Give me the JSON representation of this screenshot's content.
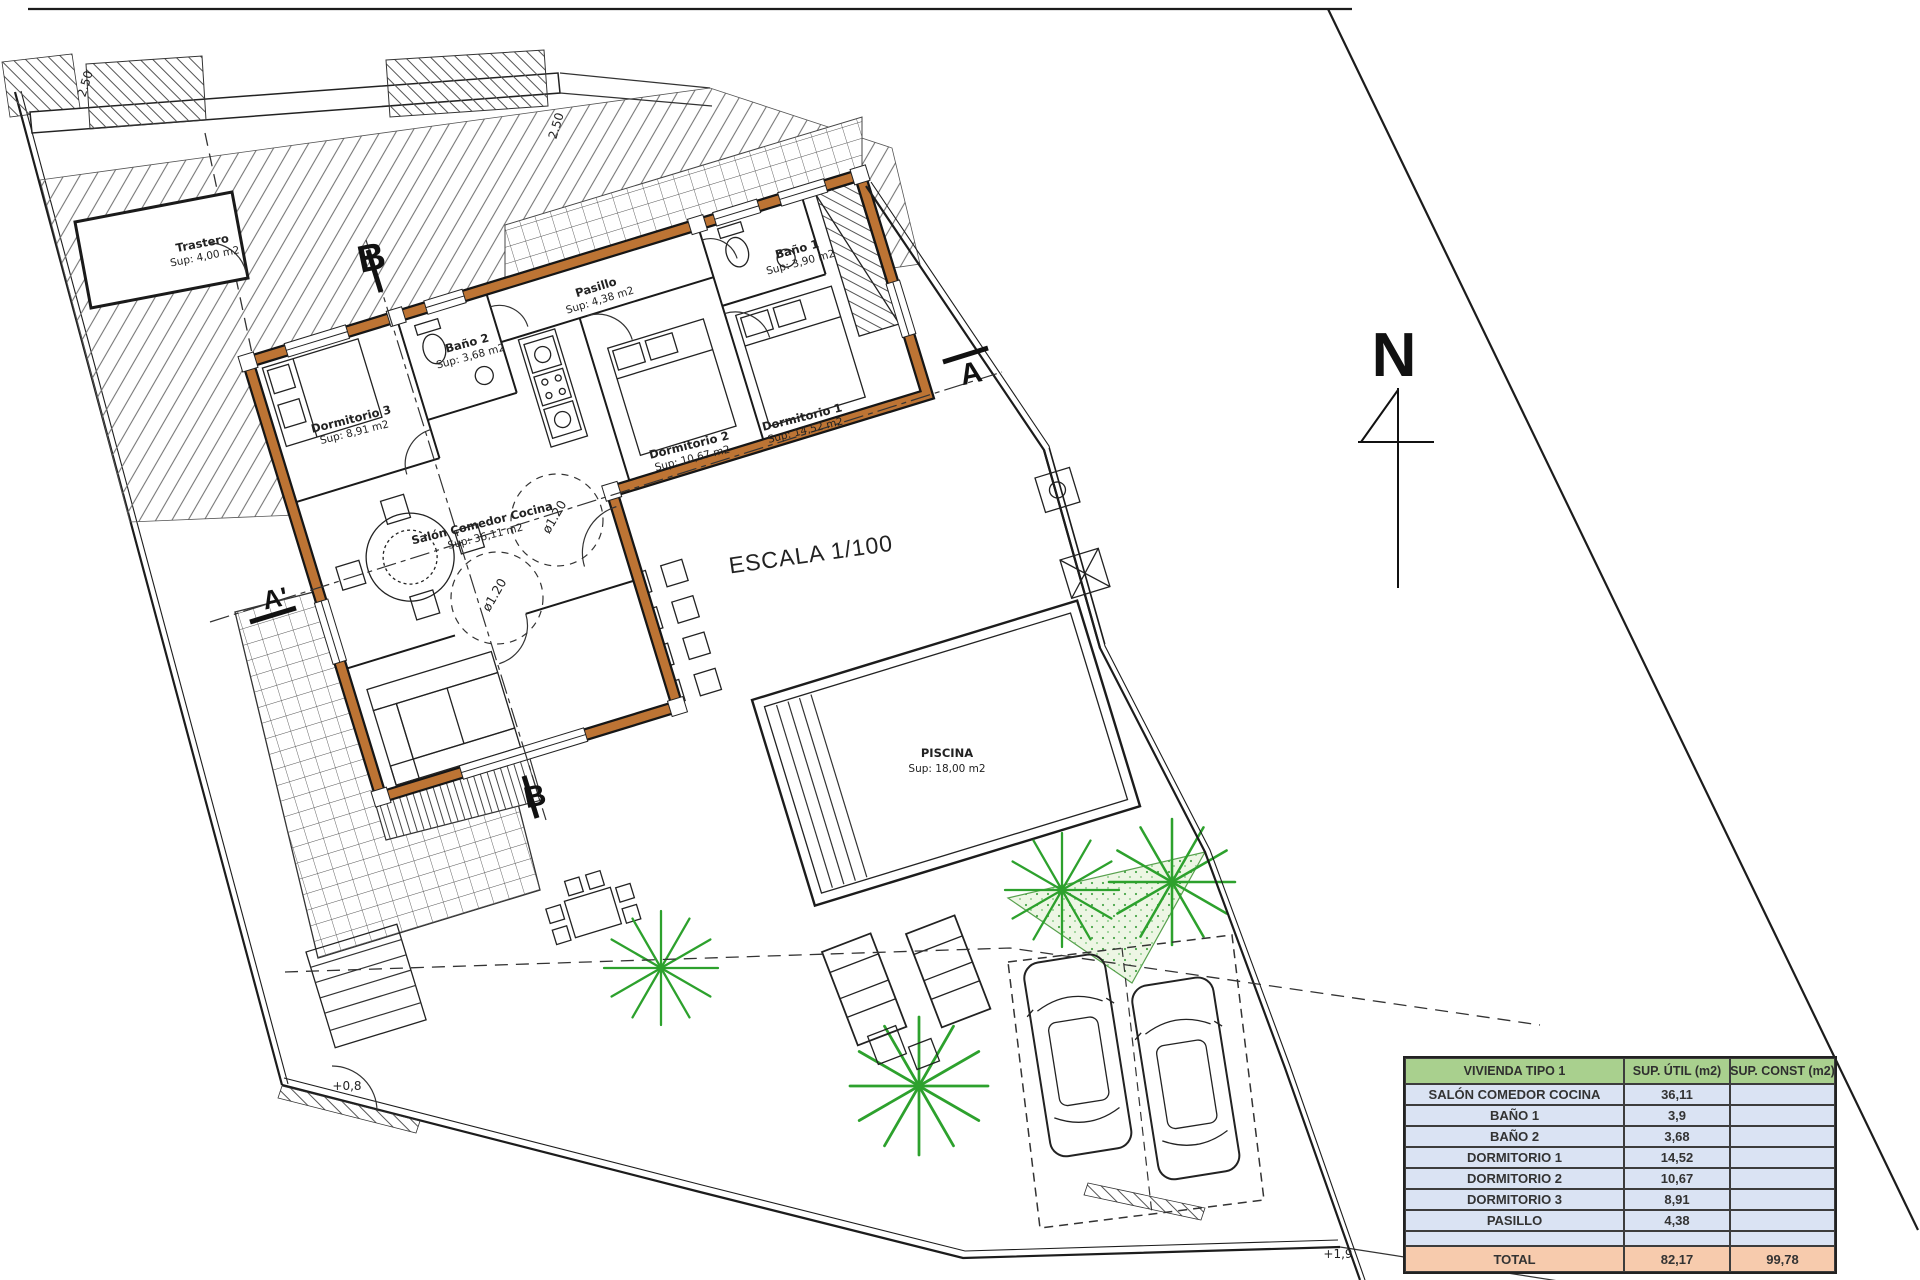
{
  "sheet": {
    "scale_label": "ESCALA 1/100",
    "north_label": "N"
  },
  "rooms": {
    "trastero": {
      "name": "Trastero",
      "area": "Sup: 4,00 m2"
    },
    "pasillo": {
      "name": "Pasillo",
      "area": "Sup: 4,38 m2"
    },
    "bano1": {
      "name": "Baño 1",
      "area": "Sup: 3,90 m2"
    },
    "bano2": {
      "name": "Baño 2",
      "area": "Sup: 3,68 m2"
    },
    "dormitorio1": {
      "name": "Dormitorio 1",
      "area": "Sup: 14,52 m2"
    },
    "dormitorio2": {
      "name": "Dormitorio 2",
      "area": "Sup: 10,67 m2"
    },
    "dormitorio3": {
      "name": "Dormitorio 3",
      "area": "Sup: 8,91 m2"
    },
    "salon": {
      "name": "Salón Comedor Cocina",
      "area": "Sup: 36,11 m2"
    },
    "piscina": {
      "name": "PISCINA",
      "area": "Sup: 18,00 m2"
    }
  },
  "annotations": {
    "section_b_top": "B",
    "section_a": "A",
    "section_a_prime": "A'",
    "section_b_bottom": "B",
    "diameter_1": "ø1.20",
    "diameter_2": "ø1.20",
    "level_terrace": "+0,8",
    "level_street": "+1,9",
    "dim_top": "2.50",
    "dim_corner": "2.50"
  },
  "table": {
    "headers": [
      "VIVIENDA TIPO 1",
      "SUP. ÚTIL (m2)",
      "SUP. CONST (m2)"
    ],
    "rows": [
      [
        "SALÓN COMEDOR COCINA",
        "36,11",
        ""
      ],
      [
        "BAÑO 1",
        "3,9",
        ""
      ],
      [
        "BAÑO 2",
        "3,68",
        ""
      ],
      [
        "DORMITORIO 1",
        "14,52",
        ""
      ],
      [
        "DORMITORIO 2",
        "10,67",
        ""
      ],
      [
        "DORMITORIO 3",
        "8,91",
        ""
      ],
      [
        "PASILLO",
        "4,38",
        ""
      ],
      [
        "",
        "",
        ""
      ]
    ],
    "total": [
      "TOTAL",
      "82,17",
      "99,78"
    ]
  },
  "colors": {
    "wall": "#bd7434",
    "table_header": "#a9d08e",
    "table_row": "#dae3f3",
    "table_total": "#f7cbad",
    "palm": "#2da12d"
  }
}
